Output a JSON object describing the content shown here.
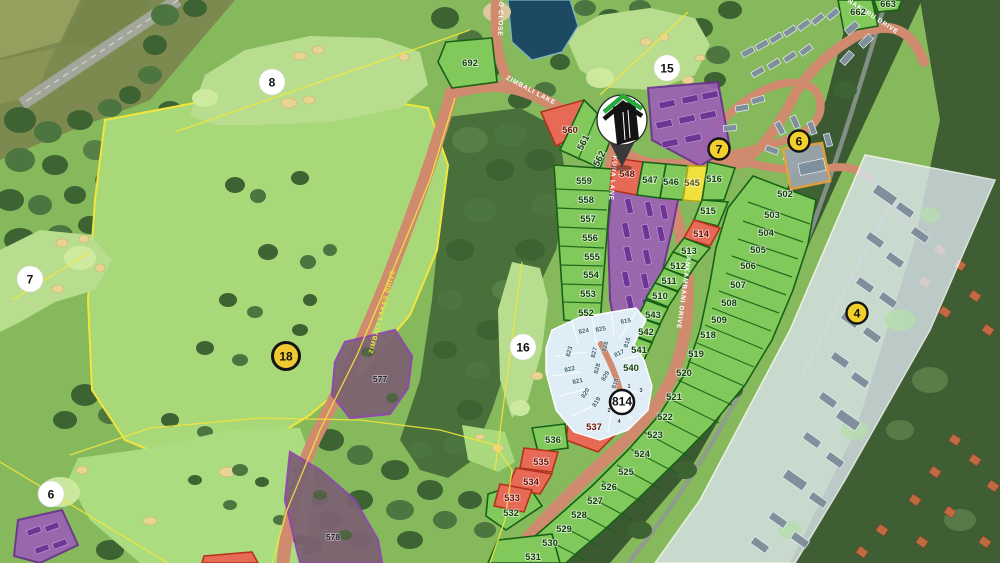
{
  "estate_map": {
    "roads": {
      "indigo_close": "INDIGO CLOSE",
      "zimbali_lake": "ZIMBALI LAKE",
      "zimbali_lakes_drive": "ZIMBALI LAKES DRIVE",
      "kura_lane": "KURA LANE",
      "sankambani_drive": "SANKAMBANI DRIVE",
      "nakuru_drive": "NAKURU DRIVE"
    },
    "golf_holes": {
      "h6": "6",
      "h7": "7",
      "h8": "8",
      "h15": "15",
      "h16": "16",
      "h18": "18"
    },
    "markers": {
      "m4": "4",
      "m6": "6",
      "m7": "7",
      "m814": "814"
    },
    "subplot_numbers": {
      "n1": "1",
      "n2": "2",
      "n3": "3",
      "n4": "4"
    },
    "plots": {
      "502": "502",
      "503": "503",
      "504": "504",
      "505": "505",
      "506": "506",
      "507": "507",
      "508": "508",
      "509": "509",
      "510": "510",
      "511": "511",
      "512": "512",
      "513": "513",
      "514": "514",
      "515": "515",
      "516": "516",
      "518": "518",
      "519": "519",
      "520": "520",
      "521": "521",
      "522": "522",
      "523": "523",
      "524": "524",
      "525": "525",
      "526": "526",
      "527": "527",
      "528": "528",
      "529": "529",
      "530": "530",
      "531": "531",
      "532": "532",
      "533": "533",
      "534": "534",
      "535": "535",
      "536": "536",
      "537": "537",
      "540": "540",
      "541": "541",
      "542": "542",
      "543": "543",
      "545": "545",
      "546": "546",
      "547": "547",
      "548": "548",
      "552": "552",
      "553": "553",
      "554": "554",
      "555": "555",
      "556": "556",
      "557": "557",
      "558": "558",
      "559": "559",
      "560": "560",
      "561": "561",
      "562": "562",
      "577": "577",
      "578": "578",
      "662": "662",
      "663": "663",
      "692": "692",
      "815": "815",
      "816": "816",
      "817": "817",
      "818": "818",
      "819": "819",
      "820": "820",
      "821": "821",
      "822": "822",
      "823": "823",
      "824": "824",
      "825": "825",
      "826": "826",
      "827": "827",
      "828": "828",
      "829": "829"
    },
    "colors": {
      "road": "#d08b6e",
      "plot_green": "#82c95b",
      "plot_red": "#e66a55",
      "plot_yellow": "#f1e13c",
      "plot_blue": "#dfeef6",
      "complex_purple": "#9a5fb5",
      "boundary_yellow": "#f2e63c",
      "badge_yellow": "#f2cf2b",
      "overlay_white": "#d7e2e8",
      "pond_blue": "#1d4a63"
    }
  }
}
